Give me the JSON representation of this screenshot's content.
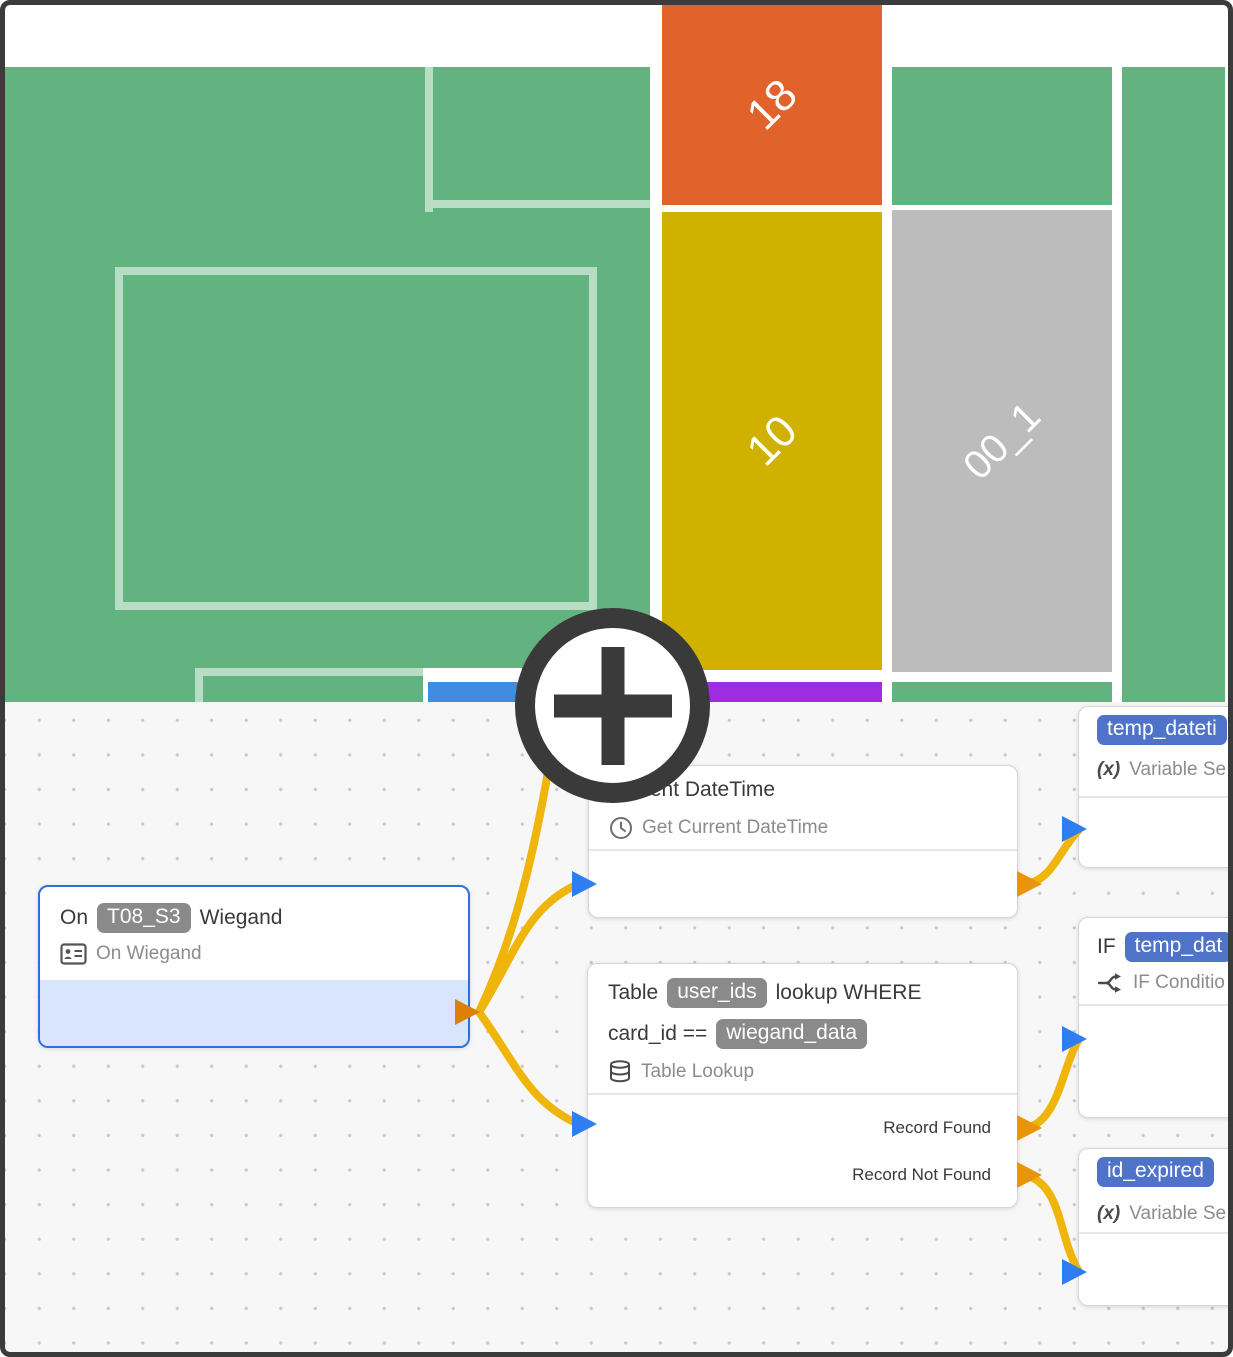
{
  "treemap": {
    "block_18": {
      "label": "18",
      "color": "#e2622b"
    },
    "block_10": {
      "label": "10",
      "color": "#d0b100"
    },
    "block_00_1": {
      "label": "00_1",
      "color": "#bcbcbc"
    }
  },
  "flow": {
    "wiegand": {
      "prefix": "On",
      "chip": "T08_S3",
      "suffix": "Wiegand",
      "subtitle": "On Wiegand"
    },
    "datetime": {
      "title": "Current DateTime",
      "subtitle": "Get Current DateTime"
    },
    "lookup": {
      "t1": "Table",
      "chip1": "user_ids",
      "t2": "lookup WHERE",
      "t3": "card_id ==",
      "chip2": "wiegand_data",
      "subtitle": "Table Lookup",
      "out_found": "Record Found",
      "out_not_found": "Record Not Found"
    },
    "temp_datetime": {
      "chip": "temp_dateti",
      "icon_label": "(x)",
      "subtitle": "Variable Se"
    },
    "if_condition": {
      "prefix": "IF",
      "chip": "temp_dat",
      "subtitle": "IF Conditio"
    },
    "id_expired": {
      "chip": "id_expired",
      "icon_label": "(x)",
      "subtitle": "Variable Se"
    }
  },
  "colors": {
    "green": "#62b37f",
    "pale_line": "#b9dcc5",
    "orange": "#e2622b",
    "yellow": "#d0b100",
    "gray": "#bcbcbc",
    "purple": "#9d2ce2",
    "blue_strip": "#3f8ce0",
    "canvas_bg": "#f7f7f7",
    "dot": "#c9c9c9",
    "frame": "#3b3b3b",
    "annotation": "#3a3a3a",
    "node_border": "#d6d6d6",
    "selected_border": "#2c6fe3",
    "selected_fill": "#d8e5fc",
    "chip_gray": "#8a8a8a",
    "chip_blue": "#4e73c8",
    "title_color": "#3a3a3a",
    "subtitle_color": "#8b8b92",
    "wire": "#f0b50b",
    "input_port": "#2e7ef2",
    "output_port": "#e8940c",
    "output_port_dark": "#dd8005"
  }
}
